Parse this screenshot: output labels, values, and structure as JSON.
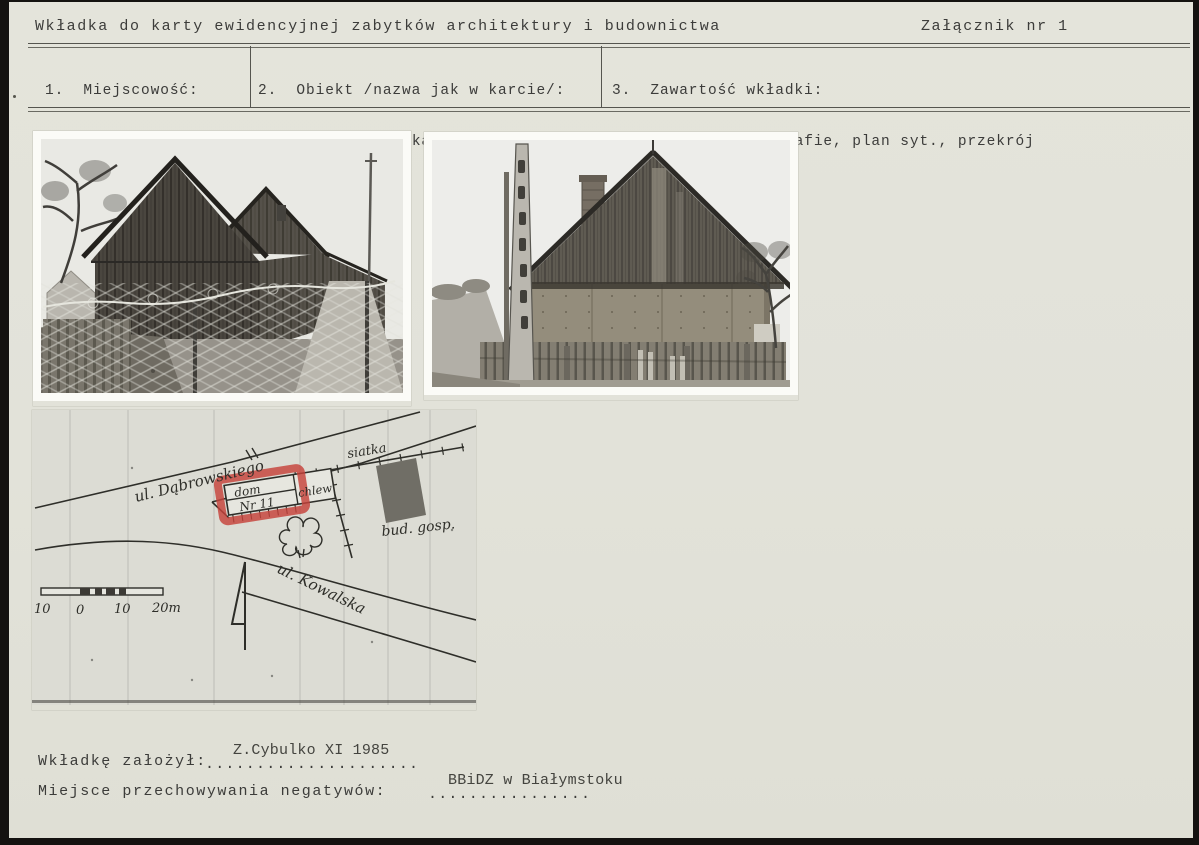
{
  "colors": {
    "paper": "#e2e2da",
    "ink": "#3c3c3a",
    "scan_edge": "#141210",
    "red_highlight": "#c6423a"
  },
  "header": {
    "title": "Wkładka do karty ewidencyjnej zabytków architektury i budownictwa",
    "annex": "Załącznik nr 1"
  },
  "table": {
    "cells": [
      {
        "number": "1.",
        "label": "Miejscowość:",
        "lines": [
          "NAREW",
          "ul. Dąbrowskiego11"
        ]
      },
      {
        "number": "2.",
        "label": "Obiekt /nazwa jak w karcie/:",
        "lines": [
          "budynek mieszkalny",
          ""
        ]
      },
      {
        "number": "3.",
        "label": "Zawartość wkładki:",
        "lines": [
          "dodatkowe fotografie, plan syt., przekrój",
          ""
        ]
      }
    ]
  },
  "site_plan": {
    "labels": {
      "street1": "ul. Dąbrowskiego",
      "street2": "ul. Kowalska",
      "fence": "siatka",
      "house_line1": "dom",
      "house_line2": "Nr 11",
      "house_ext": "chlew",
      "outbuilding": "bud. gosp."
    },
    "scale": {
      "t1": "10",
      "t2": "0",
      "t3": "10",
      "t4": "20m"
    }
  },
  "footer": {
    "line1": {
      "label": "Wkładkę założył:",
      "value": "Z.Cybulko XI 1985",
      "dots": "....................."
    },
    "line2": {
      "label": "Miejsce przechowywania negatywów:",
      "value": "BBiDZ w Białymstoku",
      "dots": "................"
    }
  }
}
